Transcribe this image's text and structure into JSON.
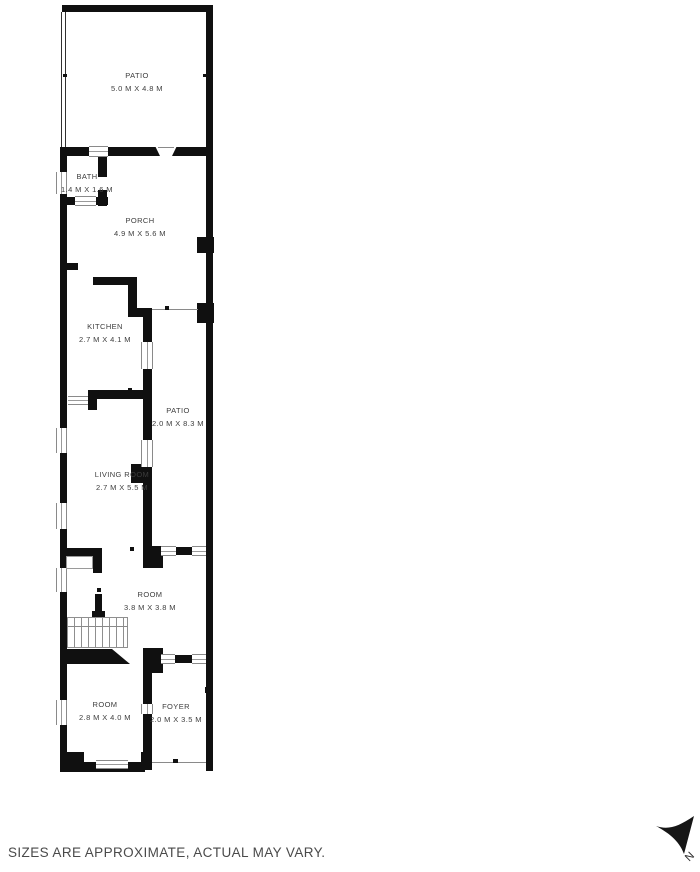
{
  "rooms": [
    {
      "name": "PATIO",
      "dims": "5.0 M X 4.8 M"
    },
    {
      "name": "BATH",
      "dims": "1.4 M X 1.6 M"
    },
    {
      "name": "PORCH",
      "dims": "4.9 M X 5.6 M"
    },
    {
      "name": "KITCHEN",
      "dims": "2.7 M X 4.1 M"
    },
    {
      "name": "PATIO",
      "dims": "2.0 M X 8.3 M"
    },
    {
      "name": "LIVING ROOM",
      "dims": "2.7 M X 5.5 M"
    },
    {
      "name": "ROOM",
      "dims": "3.8 M X 3.8 M"
    },
    {
      "name": "ROOM",
      "dims": "2.8 M X 4.0 M"
    },
    {
      "name": "FOYER",
      "dims": "2.0 M X 3.5 M"
    }
  ],
  "footer": {
    "disclaimer": "SIZES ARE APPROXIMATE, ACTUAL MAY VARY."
  },
  "compass": {
    "label": "N"
  },
  "colors": {
    "wall": "#101010",
    "label_text": "#3d3d3d",
    "thin_line": "#8a8a8a",
    "background": "#ffffff"
  }
}
